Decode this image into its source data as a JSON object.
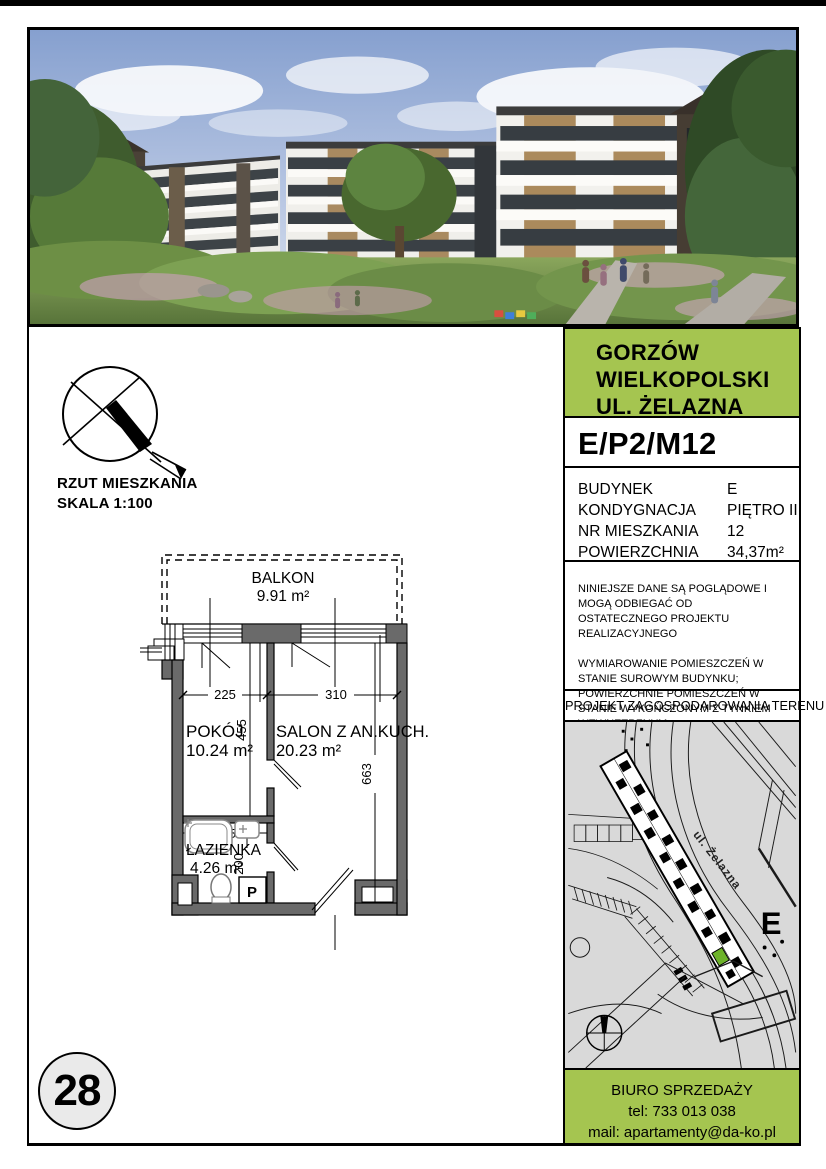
{
  "colors": {
    "accent_green": "#a5c550",
    "map_unit_green": "#6db32a",
    "wall_gray": "#6a6a6a",
    "map_bg": "#d9d9d9"
  },
  "page": {
    "number": "28"
  },
  "plan": {
    "title_line1": "RZUT MIESZKANIA",
    "title_line2": "SKALA 1:100",
    "rooms": [
      {
        "name": "BALKON",
        "area": "9.91 m²"
      },
      {
        "name": "POKÓJ",
        "area": "10.24 m²"
      },
      {
        "name": "SALON Z AN.KUCH.",
        "area": "20.23 m²"
      },
      {
        "name": "ŁAZIENKA",
        "area": "4.26 m²"
      }
    ],
    "dims": {
      "pokoj_width": "225",
      "salon_width": "310",
      "pokoj_height": "455",
      "salon_height": "663",
      "lazienka_width": "225",
      "lazienka_height": "200"
    },
    "washer_label": "P"
  },
  "sidebar": {
    "header": {
      "lines": [
        "GORZÓW",
        "WIELKOPOLSKI",
        "UL. ŻELAZNA"
      ]
    },
    "unit_code": "E/P2/M12",
    "details": {
      "rows": [
        {
          "label": "BUDYNEK",
          "value": "E"
        },
        {
          "label": "KONDYGNACJA",
          "value": "PIĘTRO II"
        },
        {
          "label": "NR MIESZKANIA",
          "value": "12"
        },
        {
          "label": "POWIERZCHNIA",
          "value": "34,37m²"
        }
      ]
    },
    "disclaimer": {
      "p1": "NINIEJSZE DANE SĄ POGLĄDOWE I MOGĄ ODBIEGAĆ OD OSTATECZNEGO PROJEKTU REALIZACYJNEGO",
      "p2": "WYMIAROWANIE POMIESZCZEŃ W STANIE SUROWYM BUDYNKU; POWIERZCHNIE POMIESZCZEŃ W STANIE WYKOŃCZONYM Z TYNKIEM WEWNĘTRZNYM"
    },
    "site_plan_title": "PROJEKT ZAGOSPODAROWANIA TERENU",
    "map": {
      "street_label": "ul. Żelazna",
      "building_label": "E"
    },
    "contact": {
      "line1": "BIURO SPRZEDAŻY",
      "line2": "tel: 733 013 038",
      "line3": "mail: apartamenty@da-ko.pl"
    }
  }
}
